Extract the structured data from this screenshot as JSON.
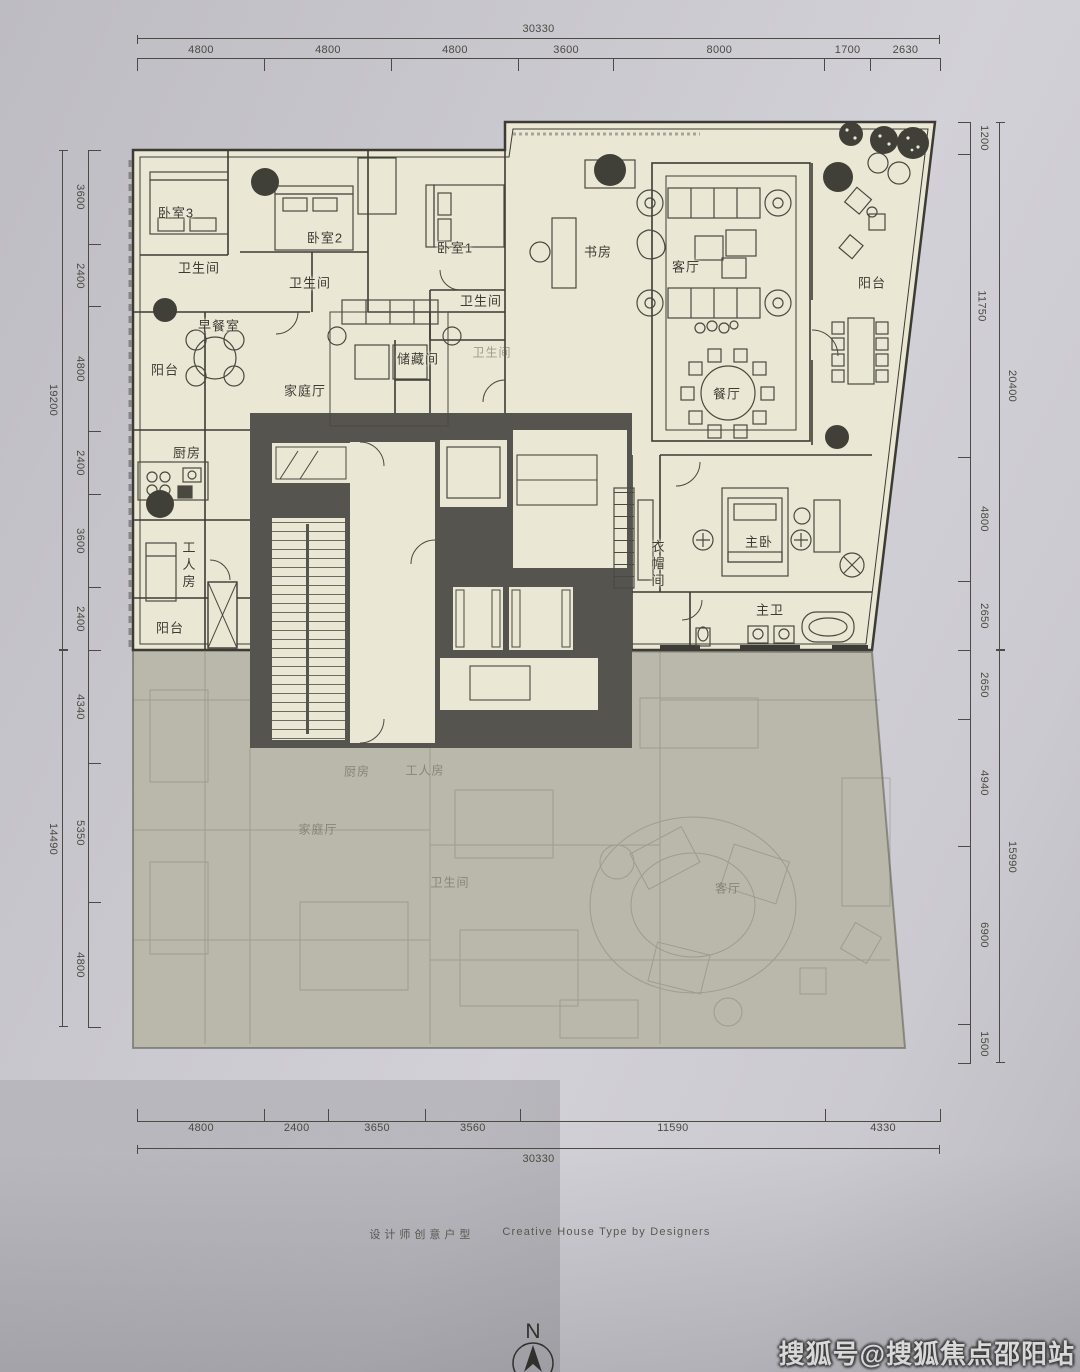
{
  "page": {
    "caption_zh": "设计师创意户型",
    "caption_en": "Creative House Type by Designers",
    "watermark": "搜狐号@搜狐焦点邵阳站",
    "compass_label": "N"
  },
  "colors": {
    "paper": "#c9c8ce",
    "plan_fill": "#ebe7d5",
    "faded_fill": "#bab7ab",
    "core_fill": "#56544e",
    "line": "#3c3b35",
    "dim_line": "#4c4a42",
    "watermark_text": "#f7f7f7"
  },
  "dimensions": {
    "top": {
      "total": "30330",
      "segments": [
        4800,
        4800,
        4800,
        3600,
        8000,
        1700,
        2630
      ]
    },
    "bottom": {
      "total": "30330",
      "segments": [
        4800,
        2400,
        3650,
        3560,
        11590,
        4330
      ]
    },
    "left_upper": {
      "total": "19200",
      "segments": [
        3600,
        2400,
        4800,
        2400,
        3600,
        2400
      ]
    },
    "left_lower": {
      "total": "14490",
      "segments": [
        4340,
        5350,
        4800
      ]
    },
    "right_upper": {
      "total": "20400",
      "segments": [
        1200,
        11750,
        4800,
        2650
      ]
    },
    "right_lower": {
      "total": "15990",
      "segments": [
        2650,
        4940,
        6900,
        1500
      ]
    }
  },
  "rooms": {
    "bedroom3": {
      "label": "卧室3"
    },
    "bath3": {
      "label": "卫生间"
    },
    "bedroom2": {
      "label": "卧室2"
    },
    "bath2": {
      "label": "卫生间"
    },
    "breakfast": {
      "label": "早餐室"
    },
    "balcony_left": {
      "label": "阳台"
    },
    "family_room": {
      "label": "家庭厅"
    },
    "bedroom1": {
      "label": "卧室1"
    },
    "bath1": {
      "label": "卫生间"
    },
    "bath_small": {
      "label": "卫生间"
    },
    "storage": {
      "label": "储藏间"
    },
    "study": {
      "label": "书房"
    },
    "living_room": {
      "label": "客厅"
    },
    "balcony_right": {
      "label": "阳台"
    },
    "dining": {
      "label": "餐厅"
    },
    "kitchen": {
      "label": "厨房"
    },
    "maid_room": {
      "label": "工人房"
    },
    "balcony_lower_left": {
      "label": "阳台"
    },
    "cloakroom": {
      "label": "衣帽间"
    },
    "master_bedroom": {
      "label": "主卧"
    },
    "master_bath": {
      "label": "主卫"
    }
  },
  "faded_rooms": {
    "kitchen": {
      "label": "厨房"
    },
    "maid_room": {
      "label": "工人房"
    },
    "family_room": {
      "label": "家庭厅"
    },
    "bath": {
      "label": "卫生间"
    },
    "living_room": {
      "label": "客厅"
    }
  }
}
